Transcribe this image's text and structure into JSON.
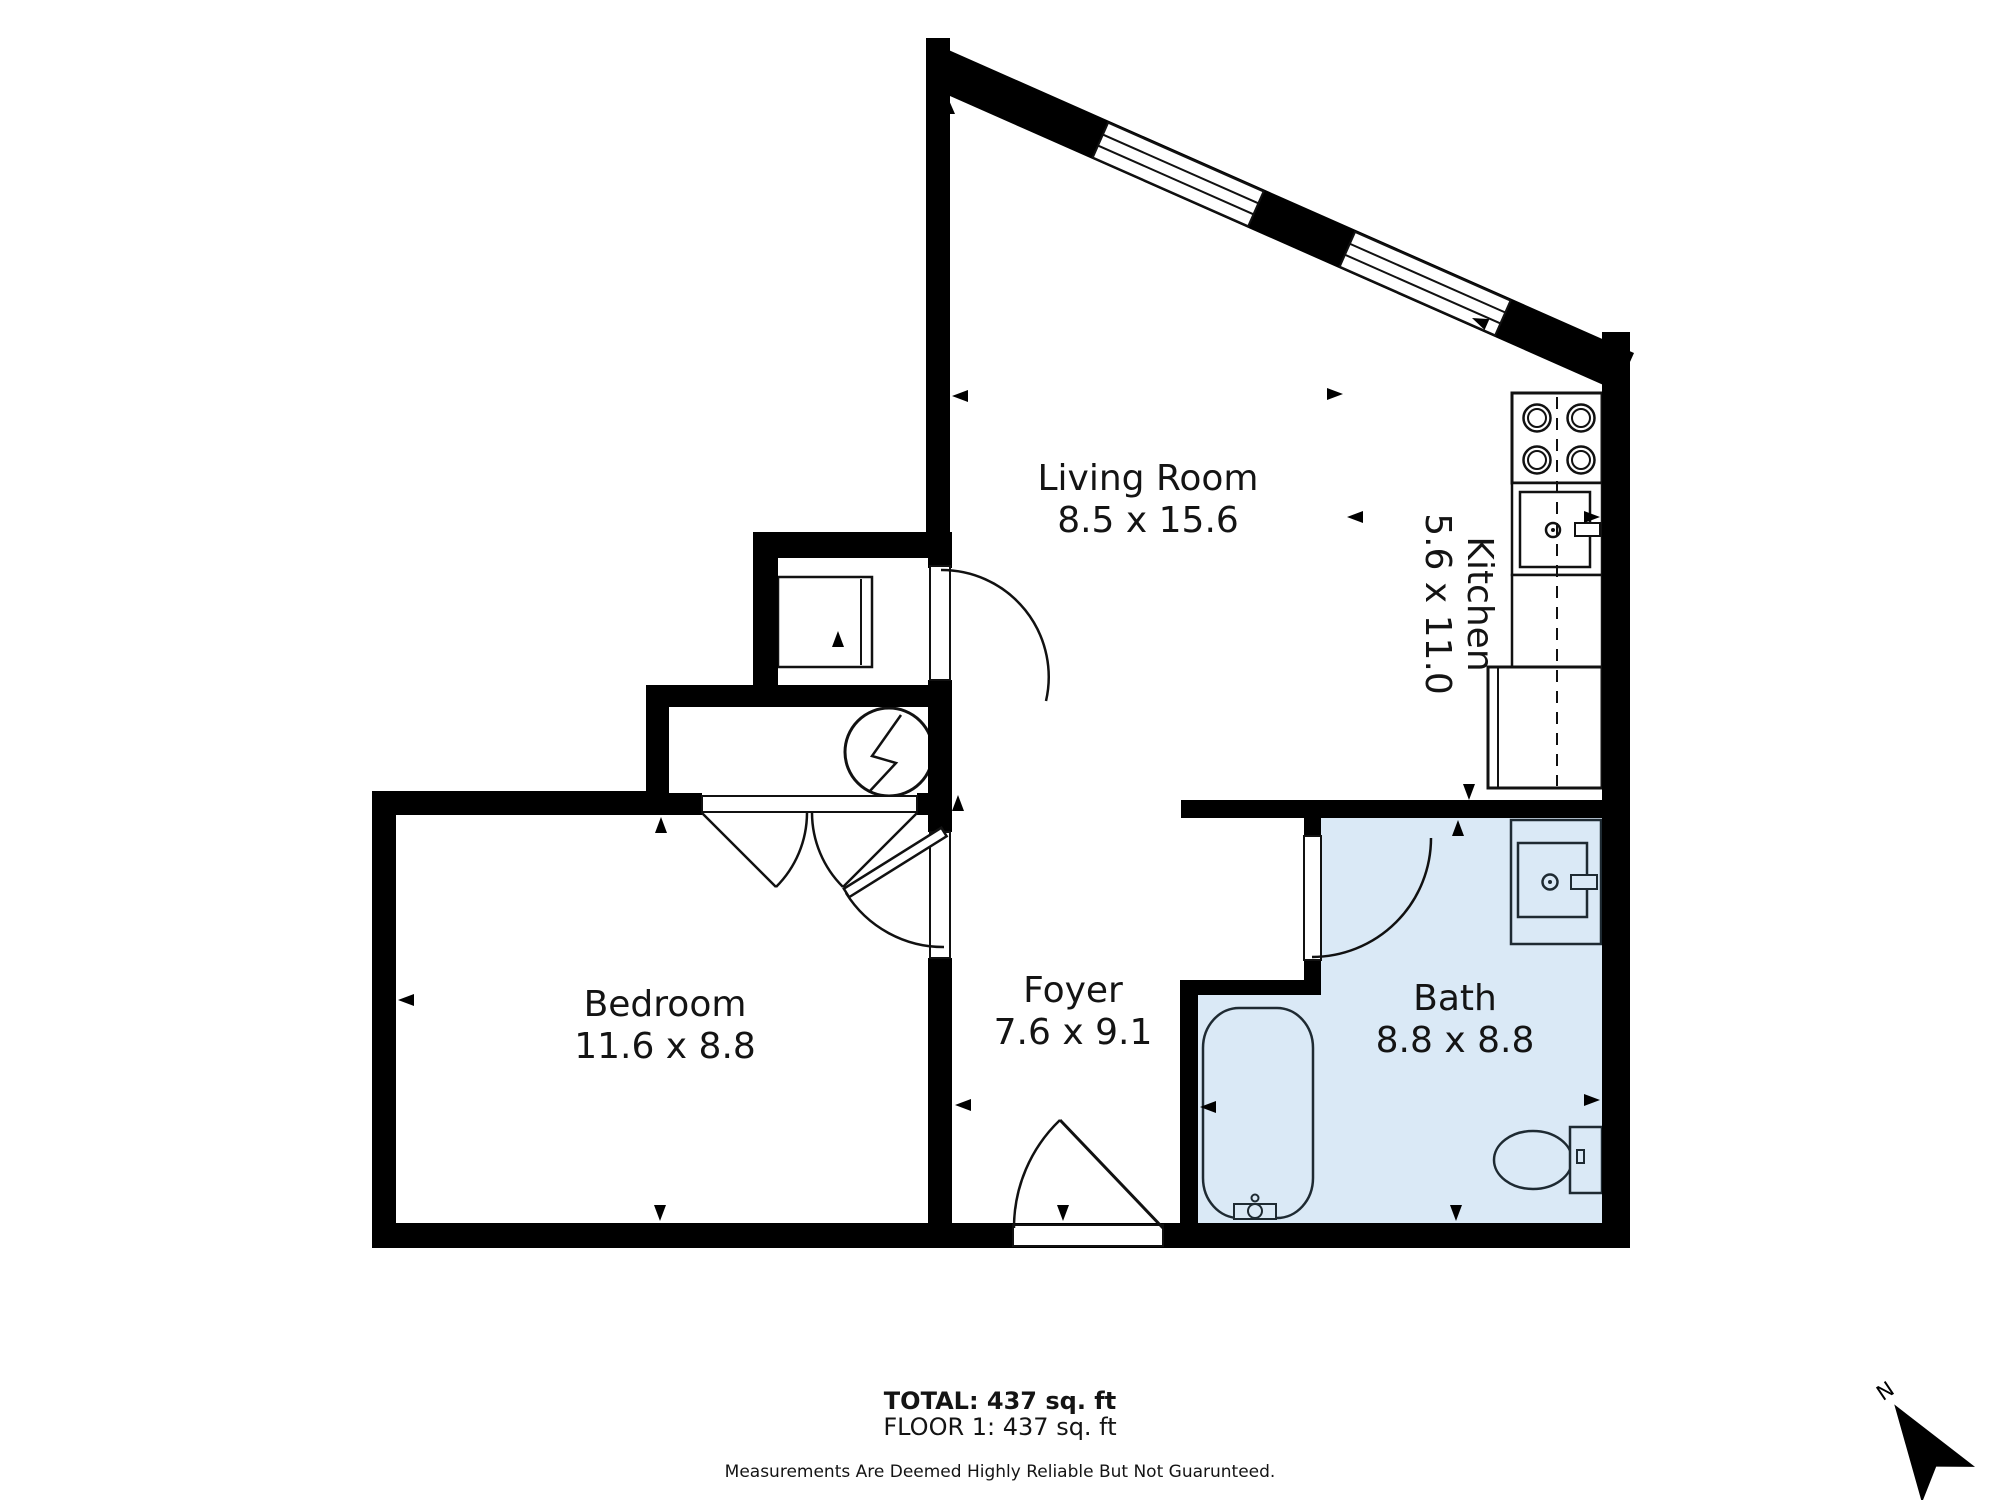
{
  "title": "Floor plan",
  "rooms": [
    {
      "name": "Living Room",
      "dims": "8.5 x 15.6"
    },
    {
      "name": "Kitchen",
      "dims": "5.6 x 11.0"
    },
    {
      "name": "Bedroom",
      "dims": "11.6 x 8.8"
    },
    {
      "name": "Foyer",
      "dims": "7.6 x 9.1"
    },
    {
      "name": "Bath",
      "dims": "8.8 x 8.8"
    }
  ],
  "footer": {
    "total": "TOTAL: 437 sq. ft",
    "floor": "FLOOR 1: 437 sq. ft",
    "disclaimer": "Measurements Are Deemed Highly Reliable But Not Guarunteed."
  },
  "north_label": "N",
  "features": {
    "windows": 2,
    "doors": 5
  },
  "fixtures": [
    "stove-icon",
    "kitchen-sink-icon",
    "refrigerator-icon",
    "water-heater-icon",
    "closet-box-icon",
    "bathtub-icon",
    "toilet-icon",
    "bathroom-sink-icon"
  ],
  "colors": {
    "wall": "#000000",
    "bath_fill": "#dae9f6",
    "background": "#ffffff",
    "fixture_line": "#1e2a32"
  }
}
